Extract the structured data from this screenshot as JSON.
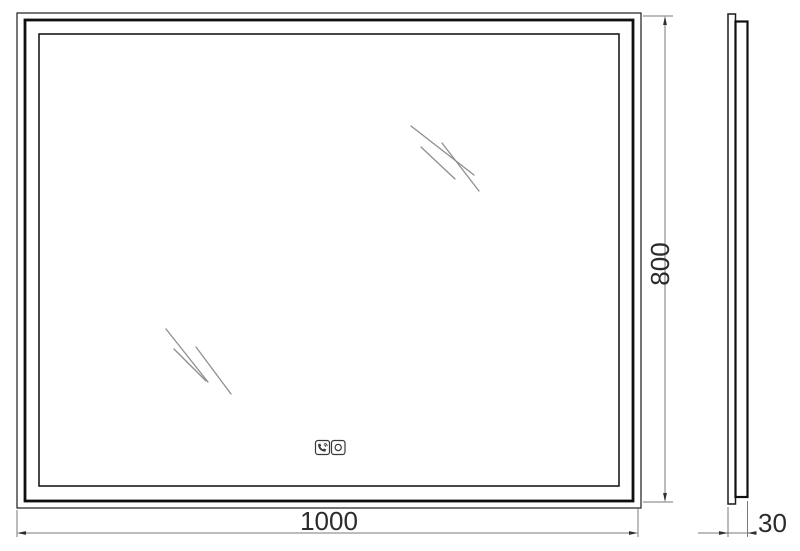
{
  "drawing": {
    "type": "technical-dimension-drawing",
    "subject": "led-mirror",
    "front_view": {
      "width_label": "1000",
      "height_label": "800"
    },
    "side_view": {
      "depth_label": "30"
    },
    "controls": {
      "left_icon": "phone-speaker-icon",
      "right_icon": "touch-sensor-icon"
    },
    "colors": {
      "outline": "#1c1c1c",
      "frame": "#0f0f0f",
      "dimension_line": "#7a7a7a",
      "arrow": "#2f2f2f",
      "label_text": "#2b2b2b",
      "shine": "#8f8f8f",
      "icon_line": "#3a3a3a",
      "background": "#ffffff"
    }
  }
}
